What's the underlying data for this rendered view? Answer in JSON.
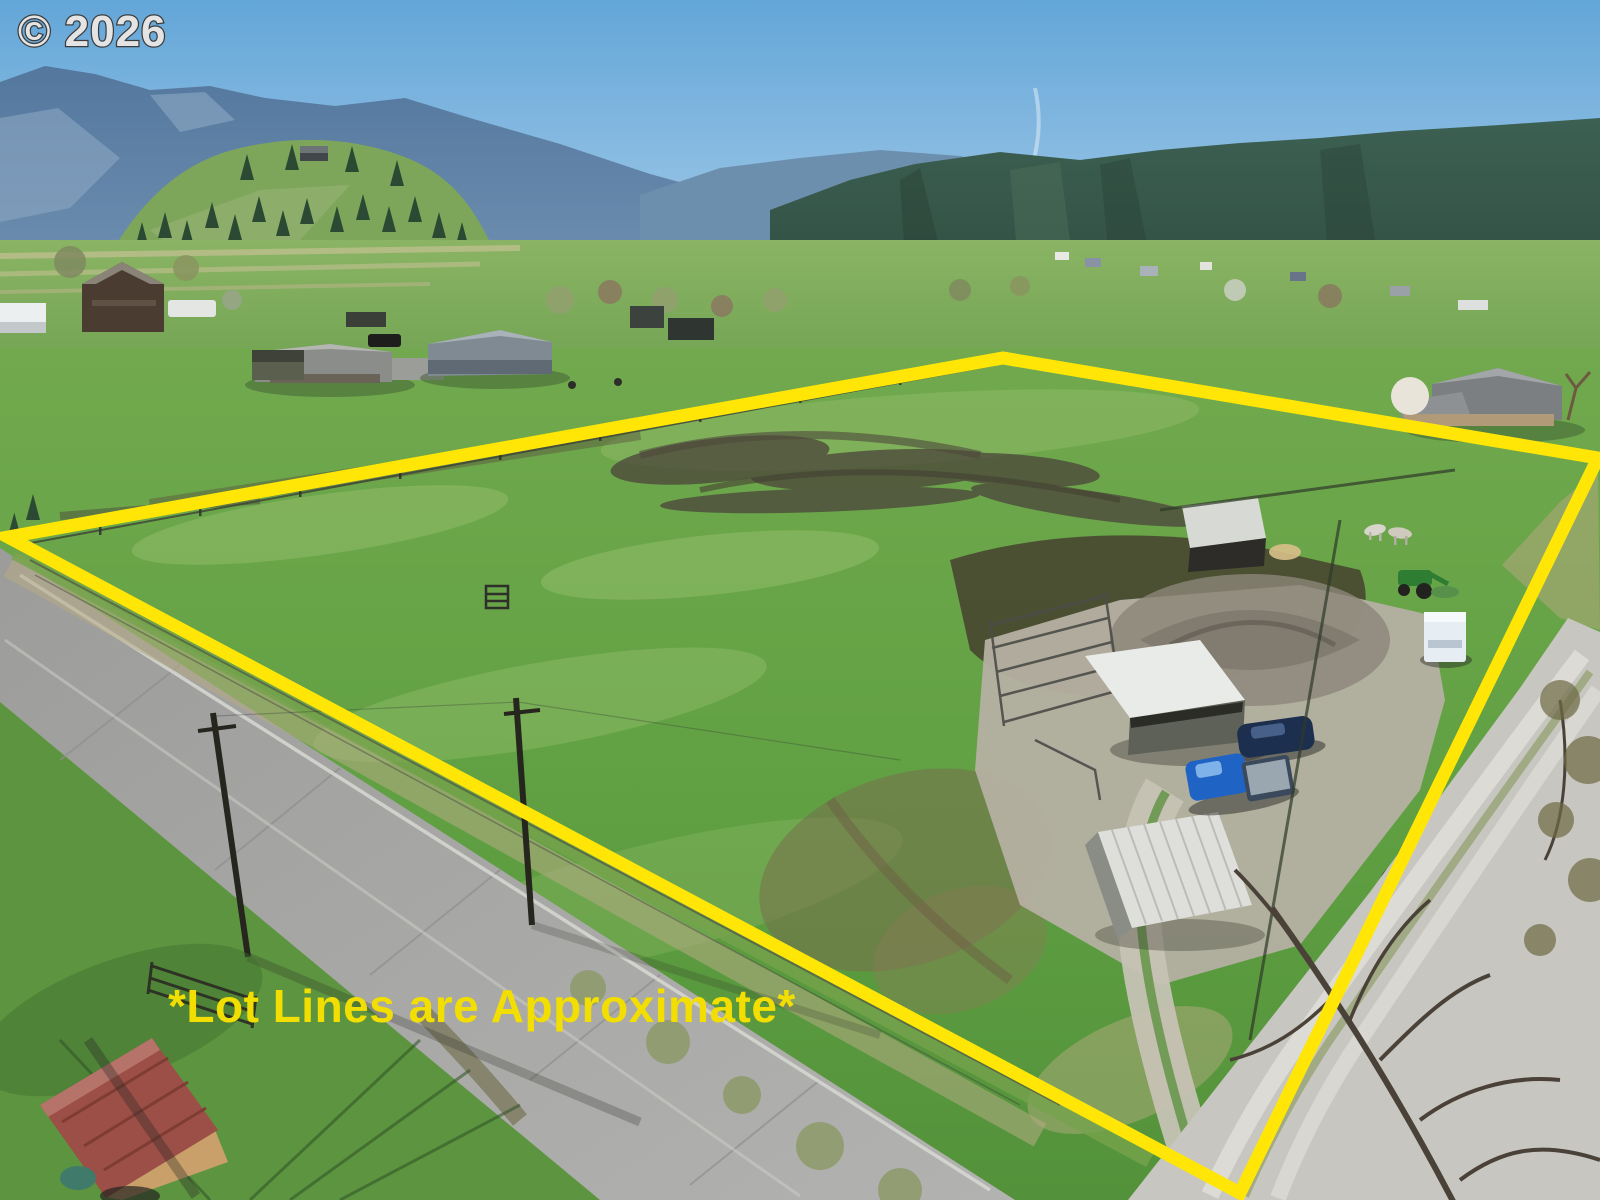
{
  "watermark": {
    "text": "© 2026",
    "fill": "#e4e4e4",
    "outline": "#3c3c3c"
  },
  "disclaimer": {
    "text": "*Lot Lines are Approximate*",
    "fill": "#f2de00"
  },
  "lot_outline": {
    "color": "#ffe606",
    "stroke_width": "13",
    "points": "8,537 1003,358 1598,458 1240,1193"
  },
  "scene": {
    "description": "Aerial drone photo of a rural pasture lot outlined in yellow, with farm sheds, trucks, a horse trailer, corrals, a paved road on the left, a gravel road on the right, green valley farms and forested mountains behind",
    "colors": {
      "sky_top": "#63a6d8",
      "sky_horizon": "#c3ddee",
      "mountain_far": "#5e82a8",
      "forest": "#35574a",
      "hill_grass": "#7ea65b",
      "field_green": "#61a143",
      "road_gray": "#a8a8a6",
      "gravel": "#c7c6c0",
      "mud": "#4e4a3c",
      "red_roof": "#9b4f46",
      "shed_roof_white": "#e9ebe8",
      "pickup_blue": "#1f63c4"
    },
    "features": [
      "sky",
      "contrail",
      "mountains",
      "forested-hills",
      "hillside-conifers",
      "valley-farms",
      "pasture-lot",
      "paved-road",
      "gravel-road",
      "farm-driveway",
      "loafing-shed",
      "hay-shed",
      "run-in-shed",
      "horse-trailer",
      "suv",
      "pickup-truck",
      "tractor",
      "horses",
      "corral-fencing",
      "utility-poles",
      "red-roof-outbuilding",
      "bare-trees",
      "mud-patches",
      "fence-lines"
    ]
  }
}
